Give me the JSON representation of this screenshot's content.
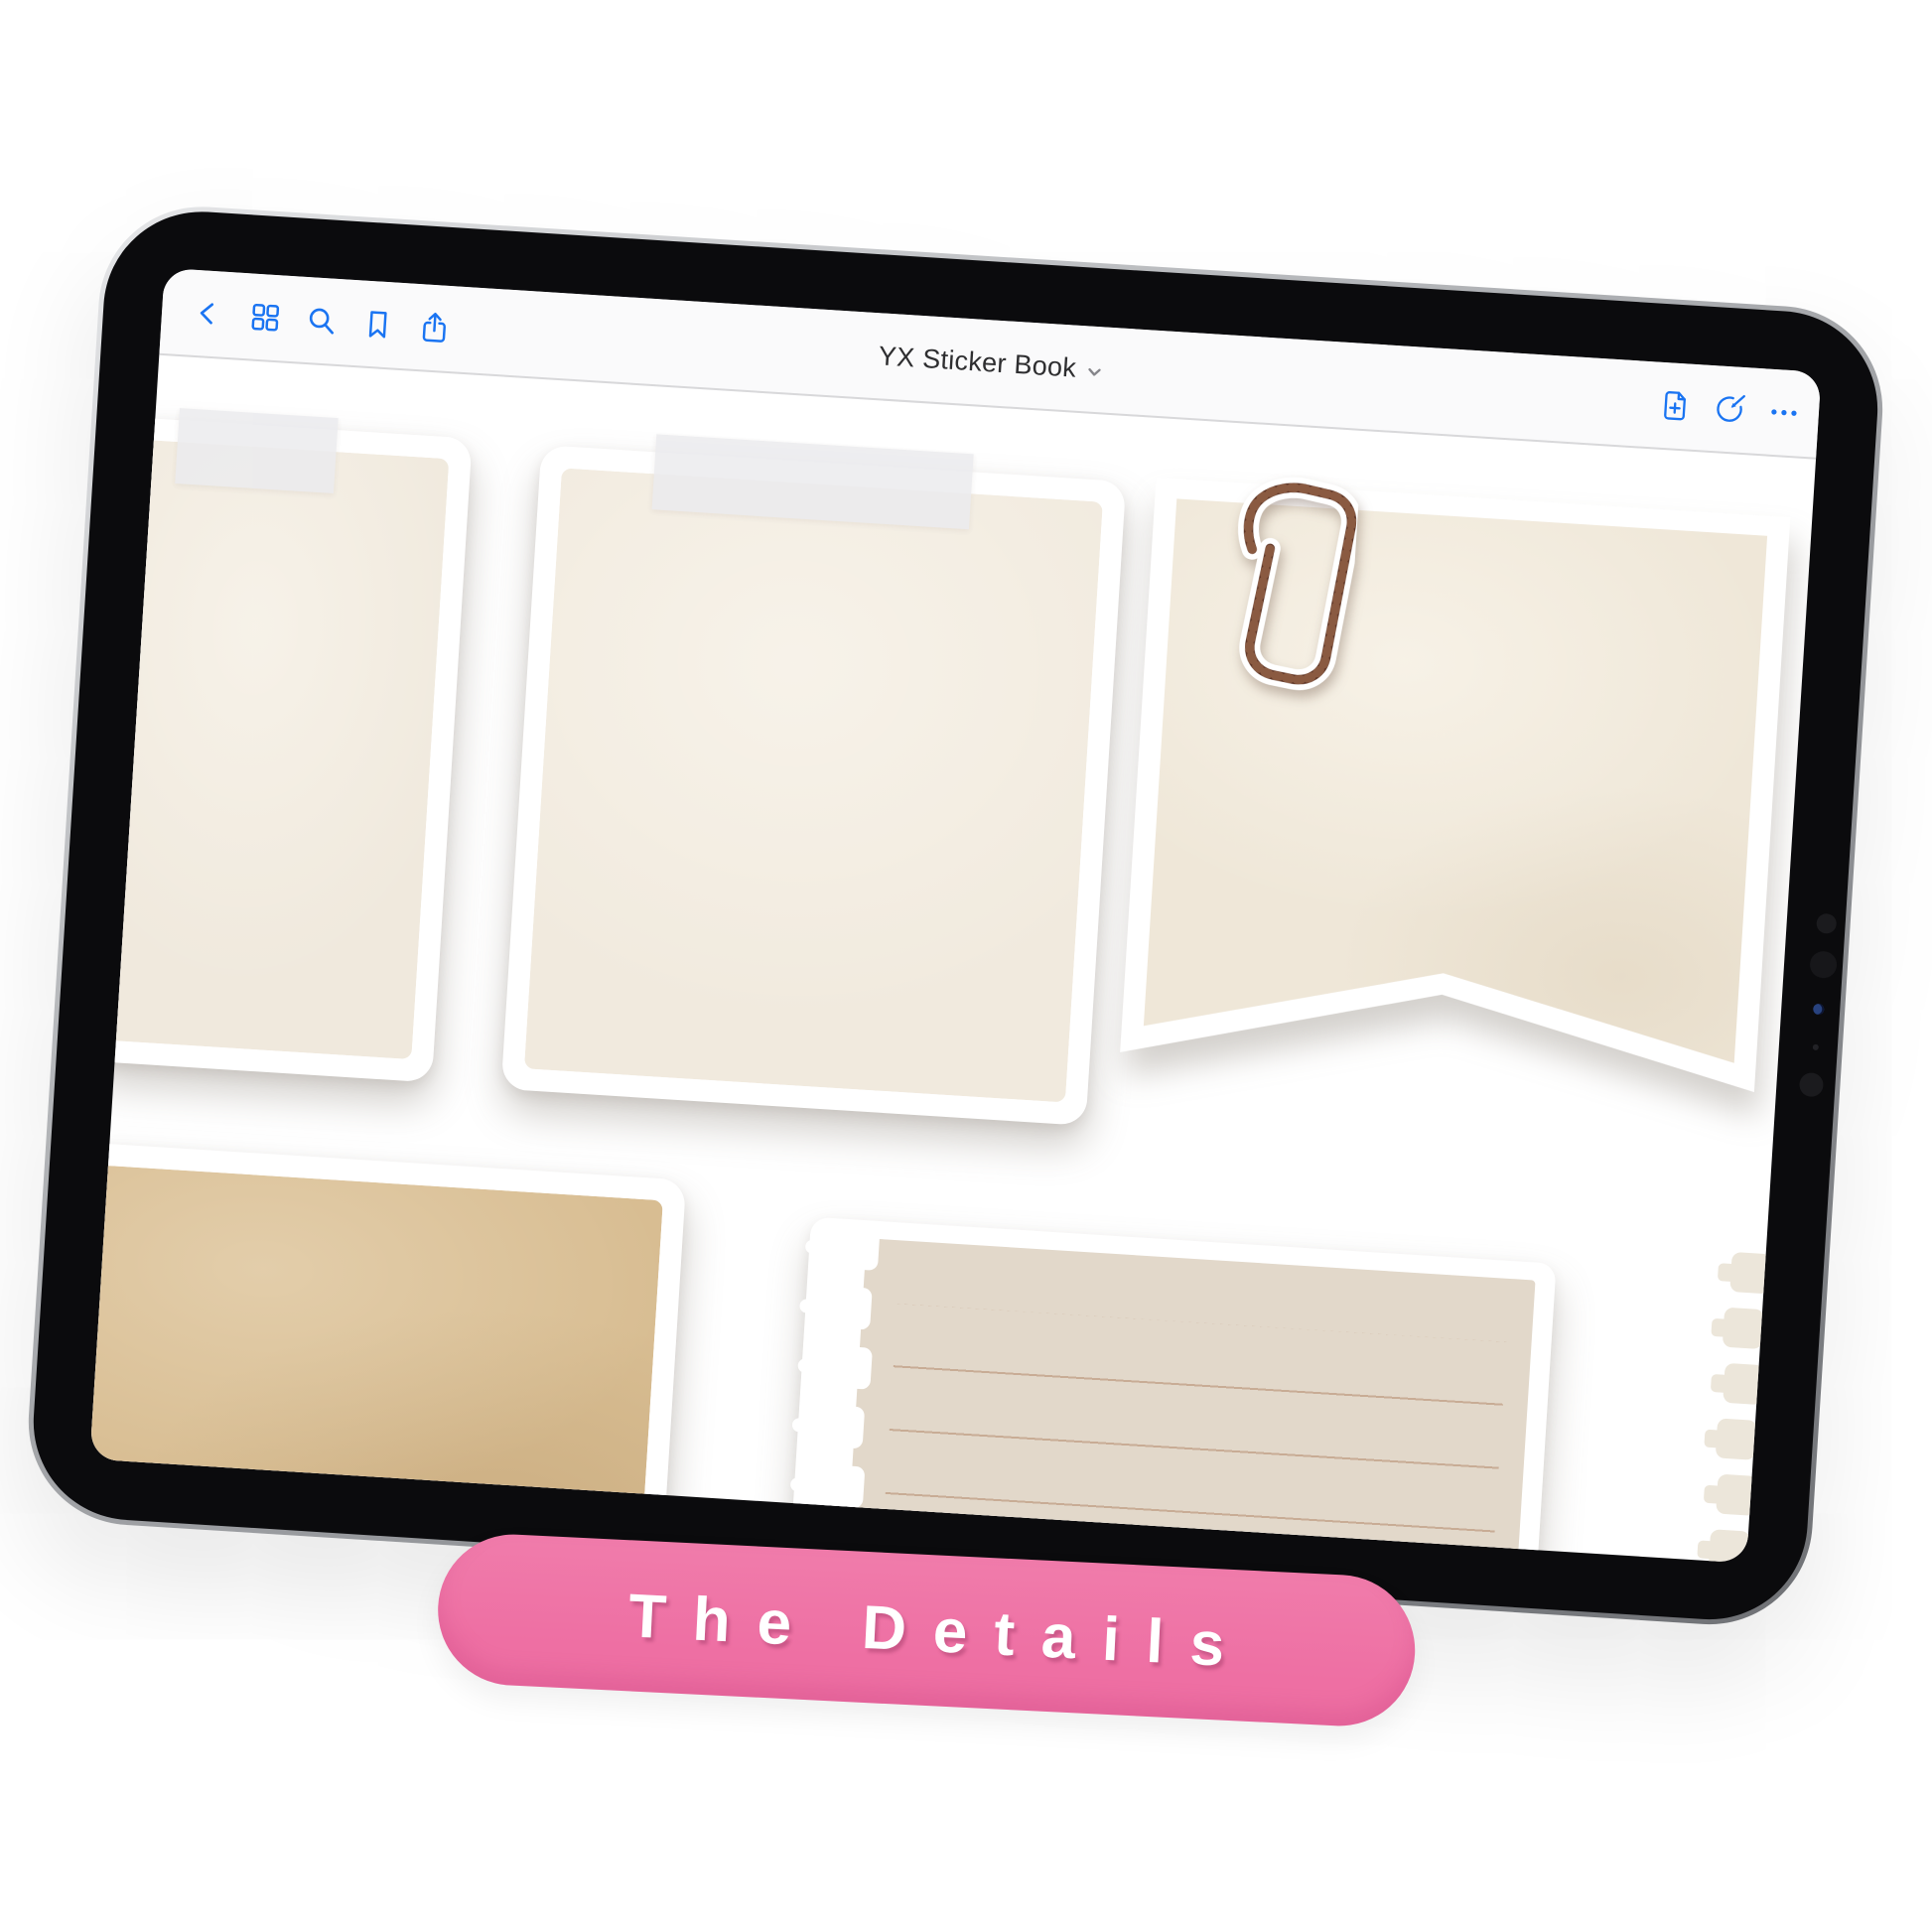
{
  "window": {
    "title": "YX Sticker Book"
  },
  "toolbar": {
    "left_icons": [
      "back",
      "page-thumbnails",
      "search",
      "bookmark",
      "share"
    ],
    "right_icons": [
      "add-page",
      "markup",
      "more"
    ]
  },
  "banner": {
    "label": "The Details"
  },
  "canvas": {
    "stickers": [
      {
        "name": "taped note (partial, left edge)",
        "fill": "#F0E9DD",
        "tape": true
      },
      {
        "name": "taped note",
        "fill": "#F1EADE",
        "tape": true
      },
      {
        "name": "flag banner with paperclip",
        "fill": "#EFE7D8",
        "paperclip": true
      },
      {
        "name": "kraft paper card",
        "fill": "#D8BD92"
      },
      {
        "name": "torn notebook paper",
        "fill": "#E2D8CA",
        "ruled_lines": 5
      },
      {
        "name": "torn notebook edge (partial, right edge)",
        "fill": "#ECE6DA"
      }
    ]
  },
  "colors": {
    "accent_blue": "#1A74F2",
    "title_text": "#2E2E30",
    "toolbar_bg": "#FAFAFB",
    "hairline": "#D8D8DA",
    "bezel": "#0B0B0D",
    "banner_pink": "#EE6FA3",
    "banner_text": "#FFFFFF",
    "tape": "#EBEBEE",
    "paper_cream": "#F0E9DD",
    "paper_tan": "#EFE7D8",
    "paper_kraft": "#D8BD92",
    "paper_greige": "#E2D8CA",
    "clip_bronze": "#5E3526"
  }
}
